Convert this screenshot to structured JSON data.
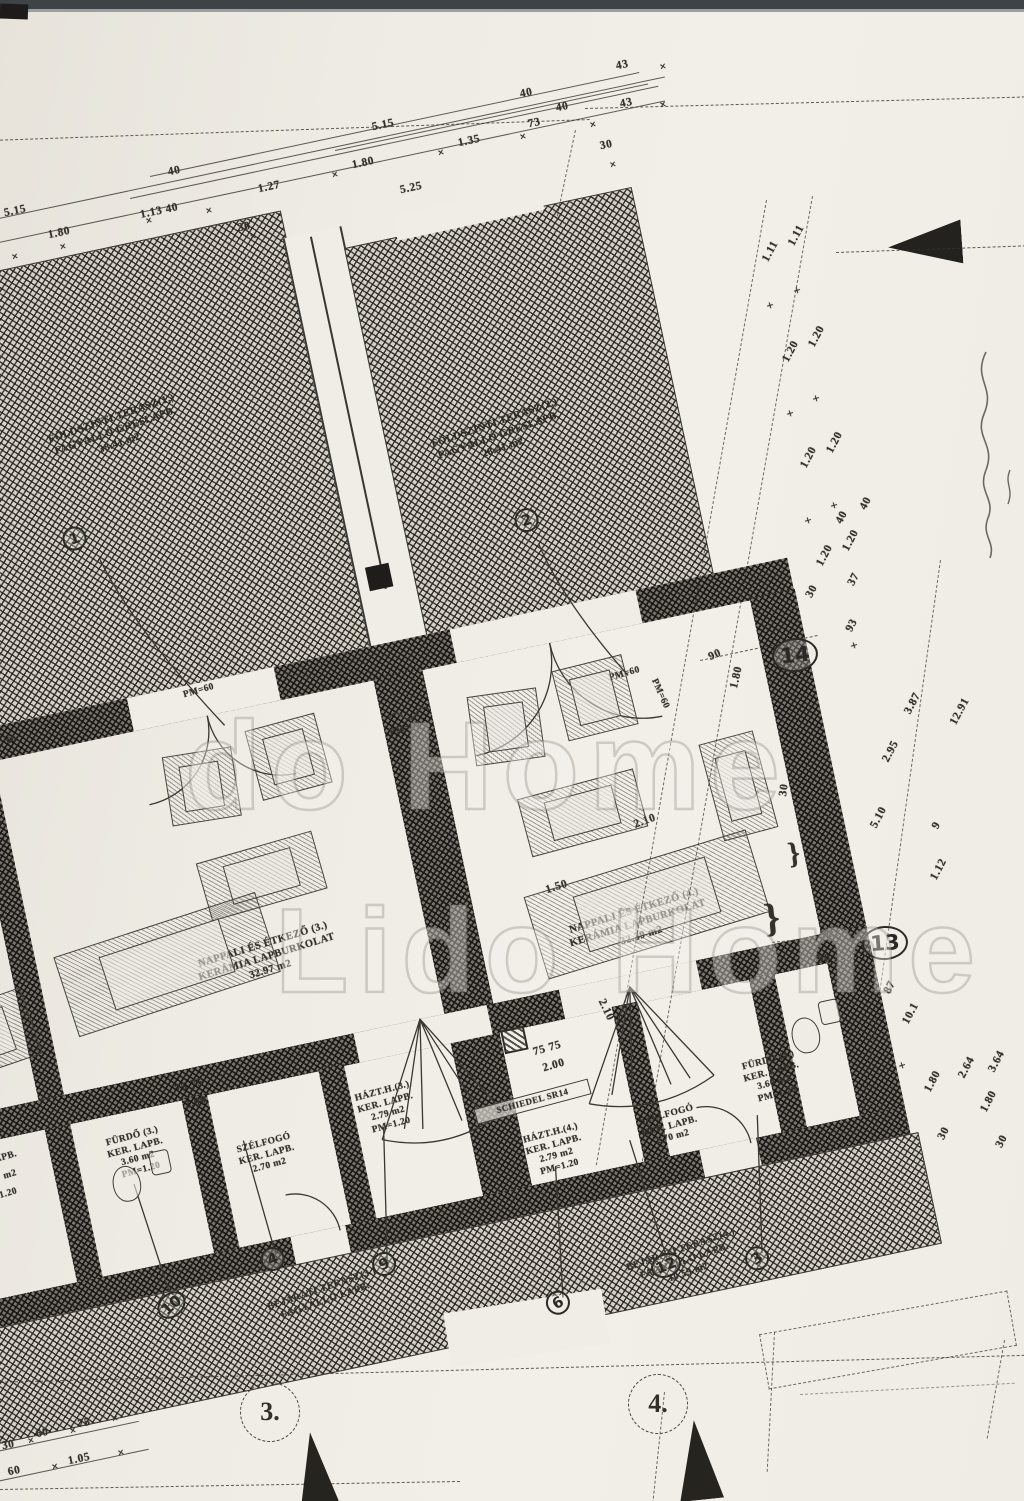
{
  "watermark": {
    "line1": "do Home",
    "line2": "Lido Home"
  },
  "colors": {
    "paper": "#f0ede6",
    "ink": "#33302b",
    "hatch_field": "#d6d0c6"
  },
  "plan": {
    "terrace_labels": [
      {
        "text": "FÖLDSZINTI TERASZ(1.)\nFAGYÁLLÓ GRESLAPB.\n38.41 m2",
        "x": 22,
        "y": 190,
        "w": 185,
        "rot": -7
      },
      {
        "text": "FÖLDSZINTI TERASZ(2.)\nFAGYÁLLÓ GRESLAPB.\n28.41 m2",
        "x": 396,
        "y": 274,
        "w": 185,
        "rot": -7
      }
    ],
    "room_labels": [
      {
        "text": "NAPPALI ÉS ÉTKEZŐ (3.)\nKERÁMIA LAPBURKOLAT\n32.97 m2",
        "x": 48,
        "y": 736,
        "w": 210,
        "rot": -5
      },
      {
        "text": "NAPPALI ÉS ÉTKEZŐ (4.)\nKERÁMIA LAPBURKOLAT\n32.39 m2",
        "x": 418,
        "y": 780,
        "w": 210,
        "rot": -5
      }
    ],
    "small_room_labels": [
      {
        "text": "FÜRDŐ (3.)\nKER. LAPB.\n3.60 m2\nPM=1.20",
        "x": -68,
        "y": 898,
        "w": 106,
        "rot": -3
      },
      {
        "text": "SZÉLFOGÓ\nKER. LAPB.\n2.70 m2",
        "x": 56,
        "y": 932,
        "w": 112,
        "rot": -3
      },
      {
        "text": "HÁZT.H.(3.)\nKER. LAPB.\n2.79 m2\nPM=1.20",
        "x": 186,
        "y": 906,
        "w": 106,
        "rot": -3
      },
      {
        "text": "SCHIEDEL SR14",
        "x": 324,
        "y": 944,
        "w": 112,
        "size": 9,
        "rot": -3,
        "cls": "boxed"
      },
      {
        "text": "HÁZT.H.(4.)\nKER. LAPB.\n2.79 m2\nPM=1.20",
        "x": 342,
        "y": 982,
        "w": 106,
        "rot": -3
      },
      {
        "text": "SZÉLFOGÓ\nKER. LAPB.\n2.70 m2",
        "x": 456,
        "y": 988,
        "w": 112,
        "rot": -3
      },
      {
        "text": "FÜRDŐ (4.)\nKER. LAPB.\n3.60 m2\nPM=1.20",
        "x": 570,
        "y": 956,
        "w": 106,
        "rot": -3
      }
    ],
    "entry_labels": [
      {
        "text": "BEJÁRATI TERASZ(3.)\nFAGYÁLLÓ LAPB.",
        "x": 36,
        "y": 1086,
        "w": 205,
        "rot": -7
      },
      {
        "text": "BEJÁRATI TERASZ(4.)\nFAGYÁLLÓ LAPB.\n10.59 m2",
        "x": 396,
        "y": 1122,
        "w": 205,
        "rot": -7
      }
    ],
    "pm_labels": [
      {
        "text": "PM=60",
        "x": -78,
        "y": 486,
        "rot": -4
      },
      {
        "text": "PM=60",
        "x": 126,
        "y": 476,
        "rot": -4
      },
      {
        "text": "PM=60",
        "x": 320,
        "y": 556,
        "rot": -4
      },
      {
        "text": "PM=60",
        "x": 546,
        "y": 548,
        "rot": -4
      },
      {
        "text": "PM=60",
        "x": 576,
        "y": 574,
        "rot": 78
      }
    ],
    "dims": [
      {
        "text": "75 75",
        "x": 36,
        "y": 860,
        "rot": -4
      },
      {
        "text": "2.00",
        "x": 42,
        "y": 878,
        "rot": -4
      },
      {
        "text": "75 75",
        "x": 394,
        "y": 898,
        "rot": -4
      },
      {
        "text": "2.00",
        "x": 400,
        "y": 916,
        "rot": -4
      },
      {
        "text": "1.50",
        "x": 440,
        "y": 742,
        "rot": -6
      },
      {
        "text": "2.10",
        "x": 462,
        "y": 872,
        "rot": 76
      },
      {
        "text": "2.10",
        "x": 540,
        "y": 696,
        "rot": -8
      },
      {
        "text": "30",
        "x": 688,
        "y": 694,
        "rot": -70
      },
      {
        "text": "90",
        "x": 648,
        "y": 548,
        "rot": -12
      },
      {
        "text": "1.80",
        "x": 660,
        "y": 574,
        "rot": -65
      }
    ],
    "circles": [
      {
        "text": "1",
        "x": 40,
        "y": 294,
        "rot": -8
      },
      {
        "text": "2",
        "x": 486,
        "y": 370,
        "rot": -6
      },
      {
        "text": "10",
        "x": -28,
        "y": 1064,
        "rot": -30
      },
      {
        "text": "4",
        "x": 84,
        "y": 1040,
        "rot": -10
      },
      {
        "text": "9",
        "x": 192,
        "y": 1068,
        "rot": -14
      },
      {
        "text": "6",
        "x": 354,
        "y": 1142,
        "rot": -18
      },
      {
        "text": "12",
        "x": 464,
        "y": 1128,
        "rot": -10
      },
      {
        "text": "3",
        "x": 558,
        "y": 1140,
        "rot": -24
      }
    ],
    "fragments": [
      {
        "text": "LAPB.",
        "x": -162,
        "y": 892,
        "rot": -4
      },
      {
        "text": "m2",
        "x": -150,
        "y": 910,
        "rot": -4
      },
      {
        "text": "1.20",
        "x": -158,
        "y": 928,
        "rot": -4
      }
    ],
    "furniture": [
      {
        "x": 90,
        "y": 540,
        "w": 70,
        "h": 70,
        "rot": 3
      },
      {
        "x": 180,
        "y": 528,
        "w": 72,
        "h": 72,
        "rot": -3
      },
      {
        "x": 105,
        "y": 645,
        "w": 120,
        "h": 60,
        "rot": -4
      },
      {
        "x": -52,
        "y": 700,
        "w": 212,
        "h": 84,
        "rot": -6
      },
      {
        "x": -210,
        "y": 600,
        "w": 90,
        "h": 120,
        "rot": -6
      },
      {
        "x": -200,
        "y": 740,
        "w": 110,
        "h": 70,
        "rot": -7
      },
      {
        "x": 400,
        "y": 545,
        "w": 70,
        "h": 70,
        "rot": 4
      },
      {
        "x": 492,
        "y": 534,
        "w": 72,
        "h": 72,
        "rot": -2
      },
      {
        "x": 432,
        "y": 650,
        "w": 120,
        "h": 60,
        "rot": -3
      },
      {
        "x": 420,
        "y": 740,
        "w": 232,
        "h": 86,
        "rot": -5
      },
      {
        "x": 622,
        "y": 636,
        "w": 56,
        "h": 100,
        "rot": -3
      }
    ],
    "fixtures": [
      {
        "x": -45,
        "y": 930,
        "w": 28,
        "h": 36,
        "cls": "wc"
      },
      {
        "x": -4,
        "y": 922,
        "w": 20,
        "h": 24,
        "cls": "basin"
      },
      {
        "x": 650,
        "y": 926,
        "w": 28,
        "h": 36,
        "cls": "wc"
      },
      {
        "x": 682,
        "y": 914,
        "w": 20,
        "h": 24,
        "cls": "basin"
      },
      {
        "x": 366,
        "y": 876,
        "w": 24,
        "h": 24,
        "cls": "chimney"
      }
    ]
  },
  "dims_top": [
    {
      "text": "5.15",
      "x": 372,
      "y": 120,
      "rot": -12
    },
    {
      "text": "40",
      "x": 168,
      "y": 166,
      "rot": -12
    },
    {
      "text": "1.80",
      "x": 352,
      "y": 158,
      "rot": -12
    },
    {
      "text": "1.35",
      "x": 458,
      "y": 136,
      "rot": -12
    },
    {
      "text": "73",
      "x": 528,
      "y": 118,
      "rot": -12
    },
    {
      "text": "43",
      "x": 616,
      "y": 60,
      "rot": -12
    },
    {
      "text": "40",
      "x": 520,
      "y": 88,
      "rot": -12
    },
    {
      "text": "40",
      "x": 556,
      "y": 102,
      "rot": -12
    },
    {
      "text": "43",
      "x": 620,
      "y": 98,
      "rot": -12
    },
    {
      "text": "1.27",
      "x": 258,
      "y": 182,
      "rot": -12
    },
    {
      "text": "5.25",
      "x": 400,
      "y": 183,
      "rot": -12
    },
    {
      "text": "30",
      "x": 600,
      "y": 140,
      "rot": -12
    },
    {
      "text": "1.13  40",
      "x": 140,
      "y": 206,
      "rot": -12
    },
    {
      "text": "30",
      "x": 238,
      "y": 222,
      "rot": -12
    },
    {
      "text": "5.15",
      "x": 4,
      "y": 206,
      "rot": -12
    },
    {
      "text": "1.80",
      "x": 48,
      "y": 228,
      "rot": -12
    }
  ],
  "ticks_top": [
    {
      "text": "×",
      "x": 146,
      "y": 216,
      "rot": -12
    },
    {
      "text": "×",
      "x": 206,
      "y": 206,
      "rot": -12
    },
    {
      "text": "×",
      "x": 250,
      "y": 232,
      "rot": -12
    },
    {
      "text": "×",
      "x": 332,
      "y": 170,
      "rot": -12
    },
    {
      "text": "×",
      "x": 438,
      "y": 148,
      "rot": -12
    },
    {
      "text": "×",
      "x": 520,
      "y": 132,
      "rot": -12
    },
    {
      "text": "×",
      "x": 590,
      "y": 120,
      "rot": -12
    },
    {
      "text": "×",
      "x": 610,
      "y": 160,
      "rot": -12
    },
    {
      "text": "×",
      "x": 660,
      "y": 100,
      "rot": -12
    },
    {
      "text": "×",
      "x": 60,
      "y": 242,
      "rot": -12
    },
    {
      "text": "×",
      "x": 12,
      "y": 252,
      "rot": -12
    },
    {
      "text": "×",
      "x": 660,
      "y": 62,
      "rot": -12
    }
  ],
  "dims_right": [
    {
      "text": "1.11",
      "x": 760,
      "y": 246,
      "rot": -62
    },
    {
      "text": "1.11",
      "x": 786,
      "y": 230,
      "rot": -62
    },
    {
      "text": "1.20",
      "x": 780,
      "y": 346,
      "rot": -62
    },
    {
      "text": "1.20",
      "x": 806,
      "y": 331,
      "rot": -62
    },
    {
      "text": "1.20",
      "x": 798,
      "y": 452,
      "rot": -62
    },
    {
      "text": "1.20",
      "x": 824,
      "y": 437,
      "rot": -62
    },
    {
      "text": "1.20",
      "x": 814,
      "y": 550,
      "rot": -62
    },
    {
      "text": "1.20",
      "x": 840,
      "y": 535,
      "rot": -62
    },
    {
      "text": "40",
      "x": 836,
      "y": 512,
      "rot": -62
    },
    {
      "text": "40",
      "x": 860,
      "y": 498,
      "rot": -62
    },
    {
      "text": "30",
      "x": 806,
      "y": 586,
      "rot": -62
    },
    {
      "text": "37",
      "x": 848,
      "y": 574,
      "rot": -62
    },
    {
      "text": "93",
      "x": 846,
      "y": 620,
      "rot": -62
    },
    {
      "text": "3.87",
      "x": 902,
      "y": 698,
      "rot": -62
    },
    {
      "text": "2.95",
      "x": 880,
      "y": 746,
      "rot": -62
    },
    {
      "text": "5.10",
      "x": 868,
      "y": 812,
      "rot": -62
    },
    {
      "text": "12.91",
      "x": 946,
      "y": 706,
      "rot": -62
    },
    {
      "text": "9",
      "x": 934,
      "y": 820,
      "rot": -62
    },
    {
      "text": "1.12",
      "x": 928,
      "y": 864,
      "rot": -62
    },
    {
      "text": "50",
      "x": 820,
      "y": 930,
      "rot": -8
    },
    {
      "text": "90",
      "x": 818,
      "y": 954,
      "rot": -8
    },
    {
      "text": "87",
      "x": 884,
      "y": 982,
      "rot": -62
    },
    {
      "text": "10.1",
      "x": 900,
      "y": 1008,
      "rot": -62
    },
    {
      "text": "1.80",
      "x": 922,
      "y": 1076,
      "rot": -62
    },
    {
      "text": "30",
      "x": 938,
      "y": 1128,
      "rot": -62
    },
    {
      "text": "2.64",
      "x": 956,
      "y": 1062,
      "rot": -62
    },
    {
      "text": "3.64",
      "x": 986,
      "y": 1056,
      "rot": -62
    },
    {
      "text": "1.80",
      "x": 978,
      "y": 1096,
      "rot": -62
    },
    {
      "text": "30",
      "x": 996,
      "y": 1136,
      "rot": -62
    },
    {
      "text": "}",
      "x": 764,
      "y": 912,
      "rot": -6,
      "size": 40,
      "cls": "brace"
    },
    {
      "text": "}",
      "x": 788,
      "y": 848,
      "rot": -8,
      "size": 30,
      "cls": "brace"
    },
    {
      "text": "×",
      "x": 768,
      "y": 300,
      "rot": -62,
      "cls": "tick"
    },
    {
      "text": "×",
      "x": 795,
      "y": 285,
      "rot": -62,
      "cls": "tick"
    },
    {
      "text": "×",
      "x": 788,
      "y": 408,
      "rot": -62,
      "cls": "tick"
    },
    {
      "text": "×",
      "x": 814,
      "y": 393,
      "rot": -62,
      "cls": "tick"
    },
    {
      "text": "×",
      "x": 806,
      "y": 515,
      "rot": -62,
      "cls": "tick"
    },
    {
      "text": "×",
      "x": 832,
      "y": 500,
      "rot": -62,
      "cls": "tick"
    },
    {
      "text": "×",
      "x": 852,
      "y": 640,
      "rot": -62,
      "cls": "tick"
    },
    {
      "text": "×",
      "x": 900,
      "y": 1060,
      "rot": -62,
      "cls": "tick"
    }
  ],
  "dims_bottom": [
    {
      "text": "30",
      "x": 2,
      "y": 1440,
      "rot": -12
    },
    {
      "text": "60",
      "x": 36,
      "y": 1428,
      "rot": -12
    },
    {
      "text": "75",
      "x": 78,
      "y": 1418,
      "rot": -12
    },
    {
      "text": "60",
      "x": 8,
      "y": 1466,
      "rot": -12
    },
    {
      "text": "1.05",
      "x": 68,
      "y": 1454,
      "rot": -12
    }
  ],
  "ticks_bottom": [
    {
      "text": "×",
      "x": 28,
      "y": 1436,
      "rot": -12
    },
    {
      "text": "×",
      "x": 70,
      "y": 1426,
      "rot": -12
    },
    {
      "text": "×",
      "x": 112,
      "y": 1414,
      "rot": -12
    },
    {
      "text": "×",
      "x": 52,
      "y": 1462,
      "rot": -12
    },
    {
      "text": "×",
      "x": 118,
      "y": 1448,
      "rot": -12
    }
  ],
  "page_circles": [
    {
      "text": "14",
      "x": 772,
      "y": 638,
      "rot": -6
    },
    {
      "text": "13",
      "x": 862,
      "y": 926,
      "rot": -4
    }
  ],
  "plot_numbers": [
    {
      "text": "3.",
      "x": 240,
      "y": 1382
    },
    {
      "text": "4.",
      "x": 628,
      "y": 1374
    }
  ]
}
